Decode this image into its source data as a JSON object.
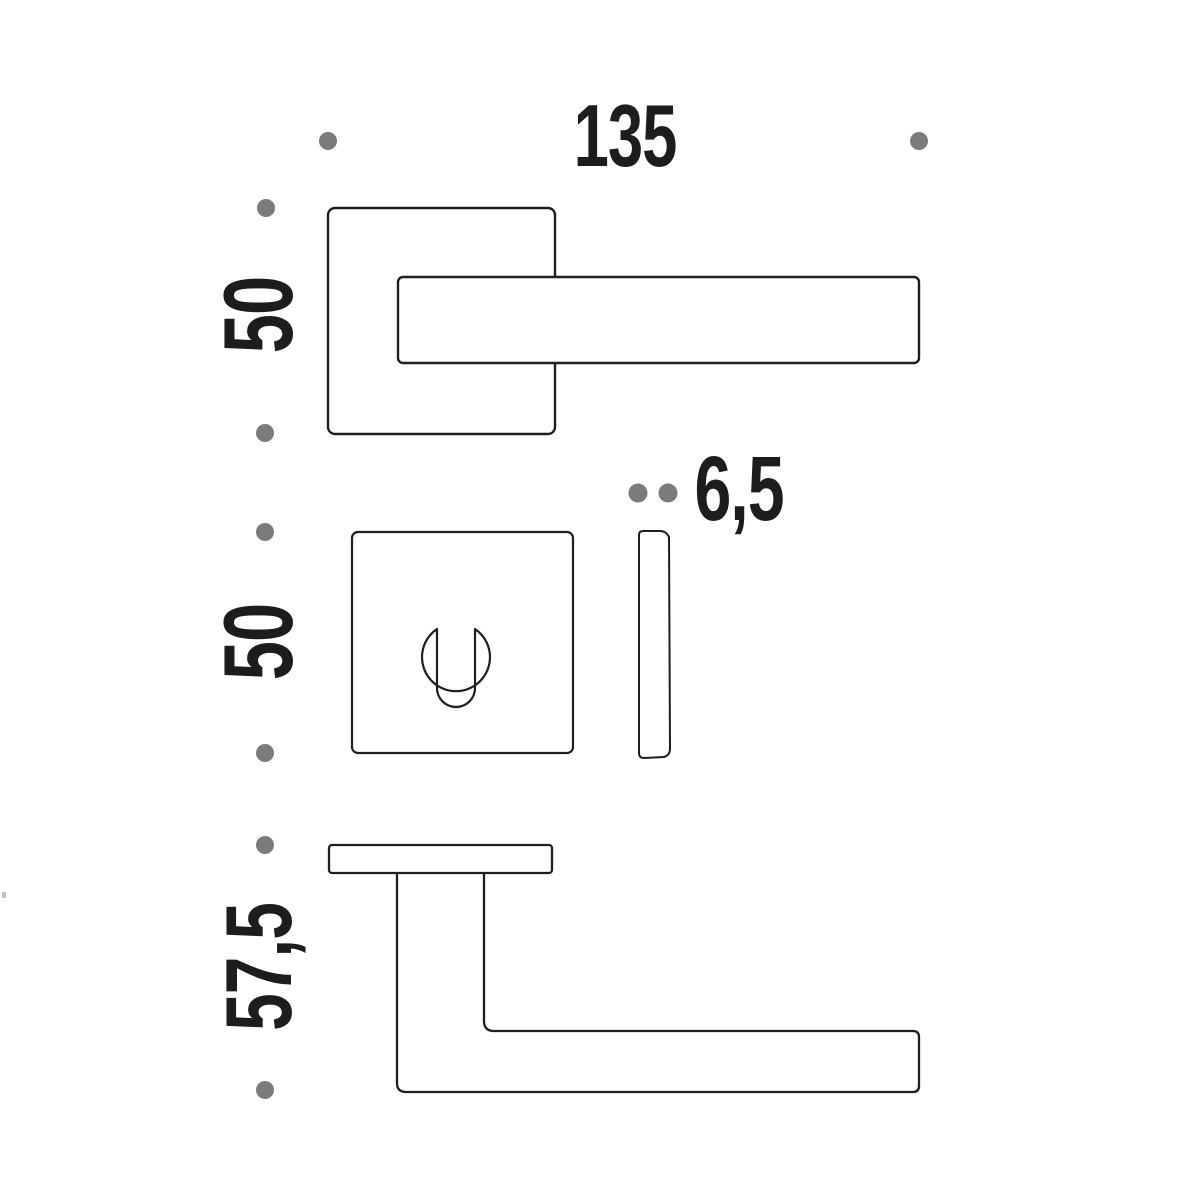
{
  "drawing_title": "door-handle-technical-drawing",
  "dimensions": {
    "lever_length_mm": "135",
    "rose_height_mm": "50",
    "escutcheon_height_mm": "50",
    "escutcheon_thickness_mm": "6,5",
    "handle_projection_mm": "57,5"
  },
  "colors": {
    "line": "#1f1f1f",
    "dot": "#7b7b7b",
    "text": "#1d1d1b",
    "background": "#ffffff"
  }
}
